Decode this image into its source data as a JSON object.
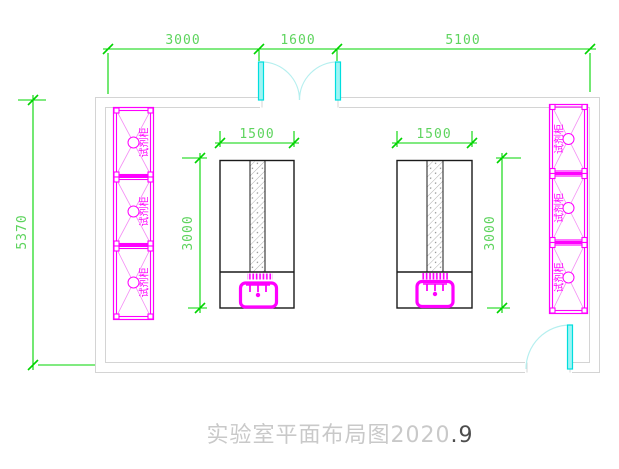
{
  "drawing": {
    "title_main": "实验室平面布局图2020",
    "title_suffix": ".9"
  },
  "dimensions": {
    "top": [
      "3000",
      "1600",
      "5100"
    ],
    "room_height": "5370",
    "benches": [
      {
        "width": "1500",
        "depth": "3000"
      },
      {
        "width": "1500",
        "depth": "3000"
      }
    ]
  },
  "cabinets": {
    "left": [
      {
        "label": "试剂柜"
      },
      {
        "label": "试剂柜"
      },
      {
        "label": "试剂柜"
      }
    ],
    "right": [
      {
        "label": "试剂柜"
      },
      {
        "label": "试剂柜"
      },
      {
        "label": "试剂柜"
      }
    ]
  },
  "colors": {
    "dimension_green": "#00d400",
    "dimension_text_green": "#5ed45e",
    "cabinet_magenta": "#ff00ff",
    "door_cyan": "#00dede",
    "door_arc_cyan": "#b5efef",
    "wall_gray": "#d4d4d4",
    "bench_black": "#1a1a1a",
    "title_gray": "#c9c9c9"
  }
}
